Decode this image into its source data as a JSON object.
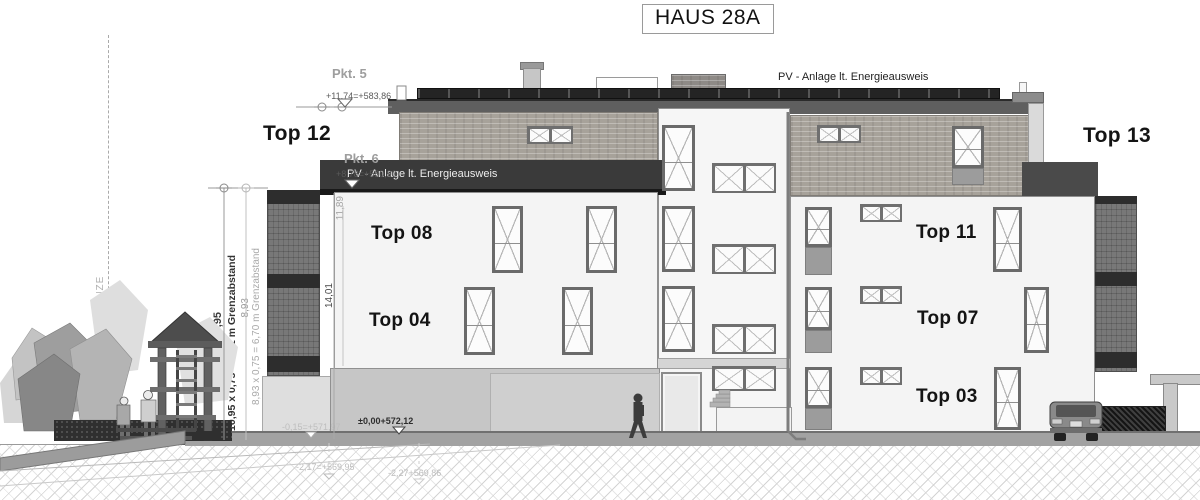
{
  "title": "HAUS 28A",
  "annotations": {
    "pkt5": {
      "label": "Pkt. 5",
      "elevation": "+11,74=+583,86"
    },
    "pkt6": {
      "label": "Pkt. 6",
      "elevation": "+8,78=+580,90"
    },
    "grundgrenze": "GRUNDGRENZE",
    "pv_left": "PV - Anlage lt. Energieausweis",
    "pv_right": "PV - Anlage lt. Energieausweis",
    "ground_zero": "±0,00+572,12",
    "ground_minus015": "-0,15=+571,97",
    "terrain_upper": "-2,17=+569,95",
    "terrain_lower": "-2,27+569,86"
  },
  "dimensions": {
    "left_total": "10,95",
    "left_formula": "10,95 x 0,75 = 8,21 m Grenzabstand",
    "right_total": "8,93",
    "right_formula": "8,93 x 0,75 = 6,70 m Grenzabstand",
    "height_total": "14,01",
    "height_upper": "11,89"
  },
  "units": {
    "top12": "Top 12",
    "top13": "Top 13",
    "top08": "Top 08",
    "top04": "Top 04",
    "top11": "Top 11",
    "top07": "Top 07",
    "top03": "Top 03"
  },
  "colors": {
    "ink": "#141414",
    "annotation": "#9e9e9e",
    "banner": "#3a3a3a",
    "wood": "#a7a29a",
    "wall": "#f4f4f4",
    "garage": "#c6c6c6",
    "solar": "#242424",
    "balcony_side": "#787878"
  }
}
